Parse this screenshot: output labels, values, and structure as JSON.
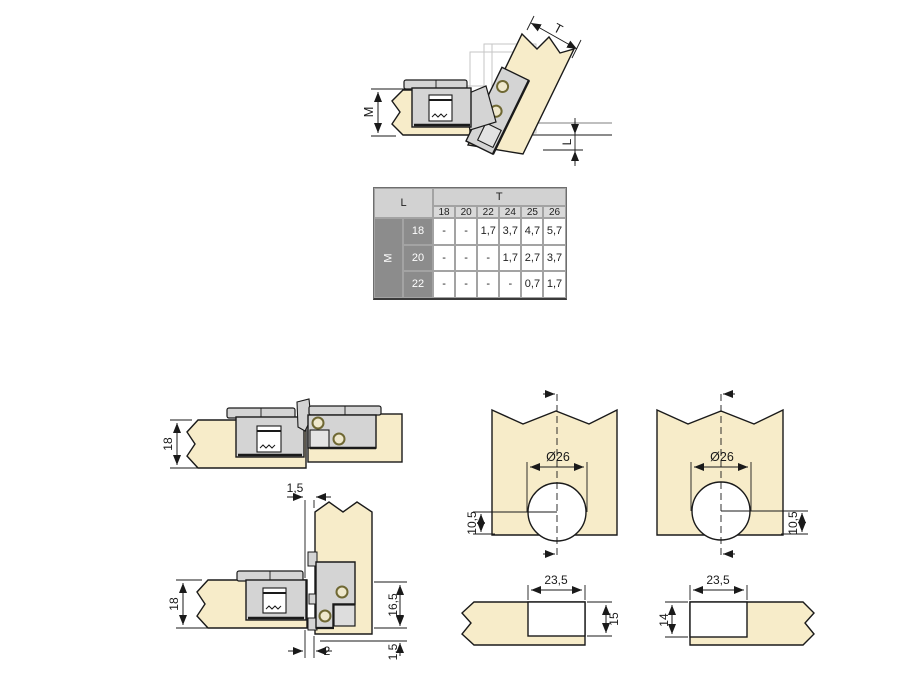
{
  "colors": {
    "panel_wood": "#f7ecc9",
    "hinge_gray": "#d4d4d4",
    "hinge_light": "#e6e6e6",
    "screw_ring": "#6f6833",
    "table_header_gray": "#d2d2d2",
    "table_dark_gray": "#8c8c8c",
    "ghost_gray": "#c6c6c6",
    "line_black": "#1a1a1a"
  },
  "top_view": {
    "dim_m": "M",
    "dim_t": "T",
    "dim_l": "L"
  },
  "table": {
    "l_header": "L",
    "t_header": "T",
    "m_header": "M",
    "t_values": [
      "18",
      "20",
      "22",
      "24",
      "25",
      "26"
    ],
    "rows": [
      {
        "m": "18",
        "cells": [
          "-",
          "-",
          "1,7",
          "3,7",
          "4,7",
          "5,7"
        ]
      },
      {
        "m": "20",
        "cells": [
          "-",
          "-",
          "-",
          "1,7",
          "2,7",
          "3,7"
        ]
      },
      {
        "m": "22",
        "cells": [
          "-",
          "-",
          "-",
          "-",
          "0,7",
          "1,7"
        ]
      }
    ]
  },
  "flat_view": {
    "panel_thickness": "18"
  },
  "corner_view": {
    "gap_top": "1,5",
    "panel_thickness": "18",
    "overlay": "16,5",
    "bottom_reveal": "1,5",
    "bottom_gap": "2"
  },
  "drill_views": {
    "left": {
      "diameter": "Ø26",
      "center_offset": "10,5"
    },
    "right": {
      "diameter": "Ø26",
      "center_offset": "10,5"
    }
  },
  "notch_views": {
    "left": {
      "width": "23,5",
      "depth": "15"
    },
    "right": {
      "width": "23,5",
      "depth": "14"
    }
  }
}
